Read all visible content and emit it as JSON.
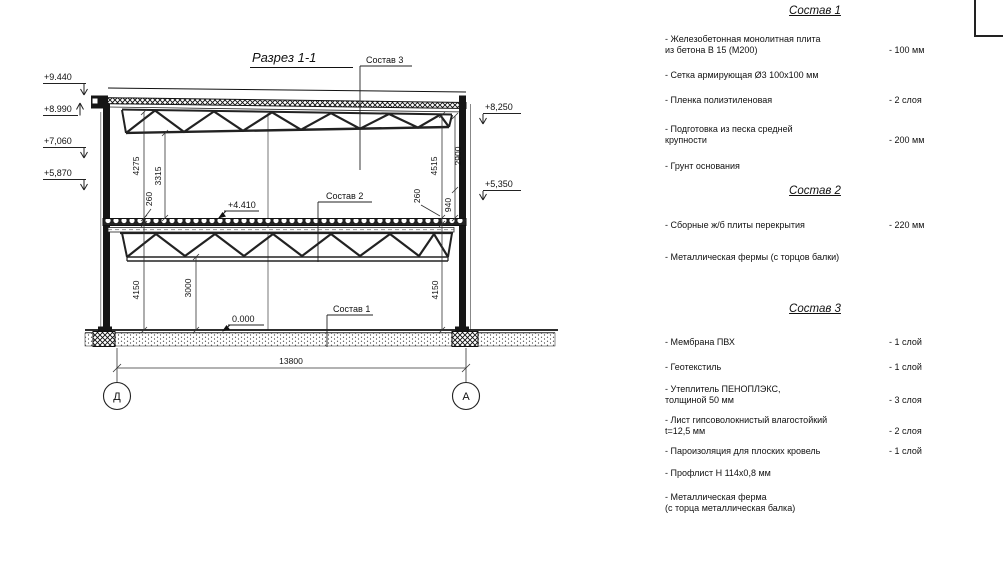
{
  "drawing": {
    "title": "Разрез 1-1",
    "callouts": {
      "c1": "Состав 1",
      "c2": "Состав 2",
      "c3": "Состав 3"
    },
    "elevations": {
      "p9440": "+9.440",
      "p8990": "+8.990",
      "p7060": "+7,060",
      "p5870": "+5,870",
      "p8250": "+8,250",
      "p5350": "+5,350",
      "p4410": "+4.410",
      "zero": "0.000"
    },
    "dims": {
      "d4275": "4275",
      "d3315": "3315",
      "d260l": "260",
      "d4515": "4515",
      "d2900": "2900",
      "d940": "940",
      "d260r": "260",
      "d4150l": "4150",
      "d3000": "3000",
      "d4150r": "4150",
      "span": "13800"
    },
    "axes": {
      "left": "Д",
      "right": "А"
    }
  },
  "panel": {
    "sections": [
      {
        "title": "Состав 1",
        "items": [
          {
            "name": "- Железобетонная  монолитная плита\nиз бетона В 15 (М200)",
            "value": "- 100 мм"
          },
          {
            "name": "- Сетка армирующая Ø3 100х100 мм",
            "value": ""
          },
          {
            "name": "- Пленка полиэтиленовая",
            "value": "- 2 слоя"
          },
          {
            "name": "- Подготовка из песка средней\nкрупности",
            "value": "- 200 мм"
          },
          {
            "name": "- Грунт основания",
            "value": ""
          }
        ]
      },
      {
        "title": "Состав 2",
        "items": [
          {
            "name": "- Сборные ж/б плиты перекрытия",
            "value": "- 220 мм"
          },
          {
            "name": "- Металлическая фермы (с торцов балки)",
            "value": ""
          }
        ]
      },
      {
        "title": "Состав 3",
        "items": [
          {
            "name": "- Мембрана ПВХ",
            "value": "- 1 слой"
          },
          {
            "name": "- Геотекстиль",
            "value": "- 1 слой"
          },
          {
            "name": "- Утеплитель ПЕНОПЛЭКС,\nтолщиной 50 мм",
            "value": "- 3 слоя"
          },
          {
            "name": "- Лист гипсоволокнистый влагостойкий\nt=12,5 мм",
            "value": "- 2 слоя"
          },
          {
            "name": "- Пароизоляция для плоских кровель",
            "value": "- 1 слой"
          },
          {
            "name": "- Профлист Н 114х0,8 мм",
            "value": ""
          },
          {
            "name": "- Металлическая ферма\n(с торца металлическая балка)",
            "value": ""
          }
        ]
      }
    ]
  }
}
